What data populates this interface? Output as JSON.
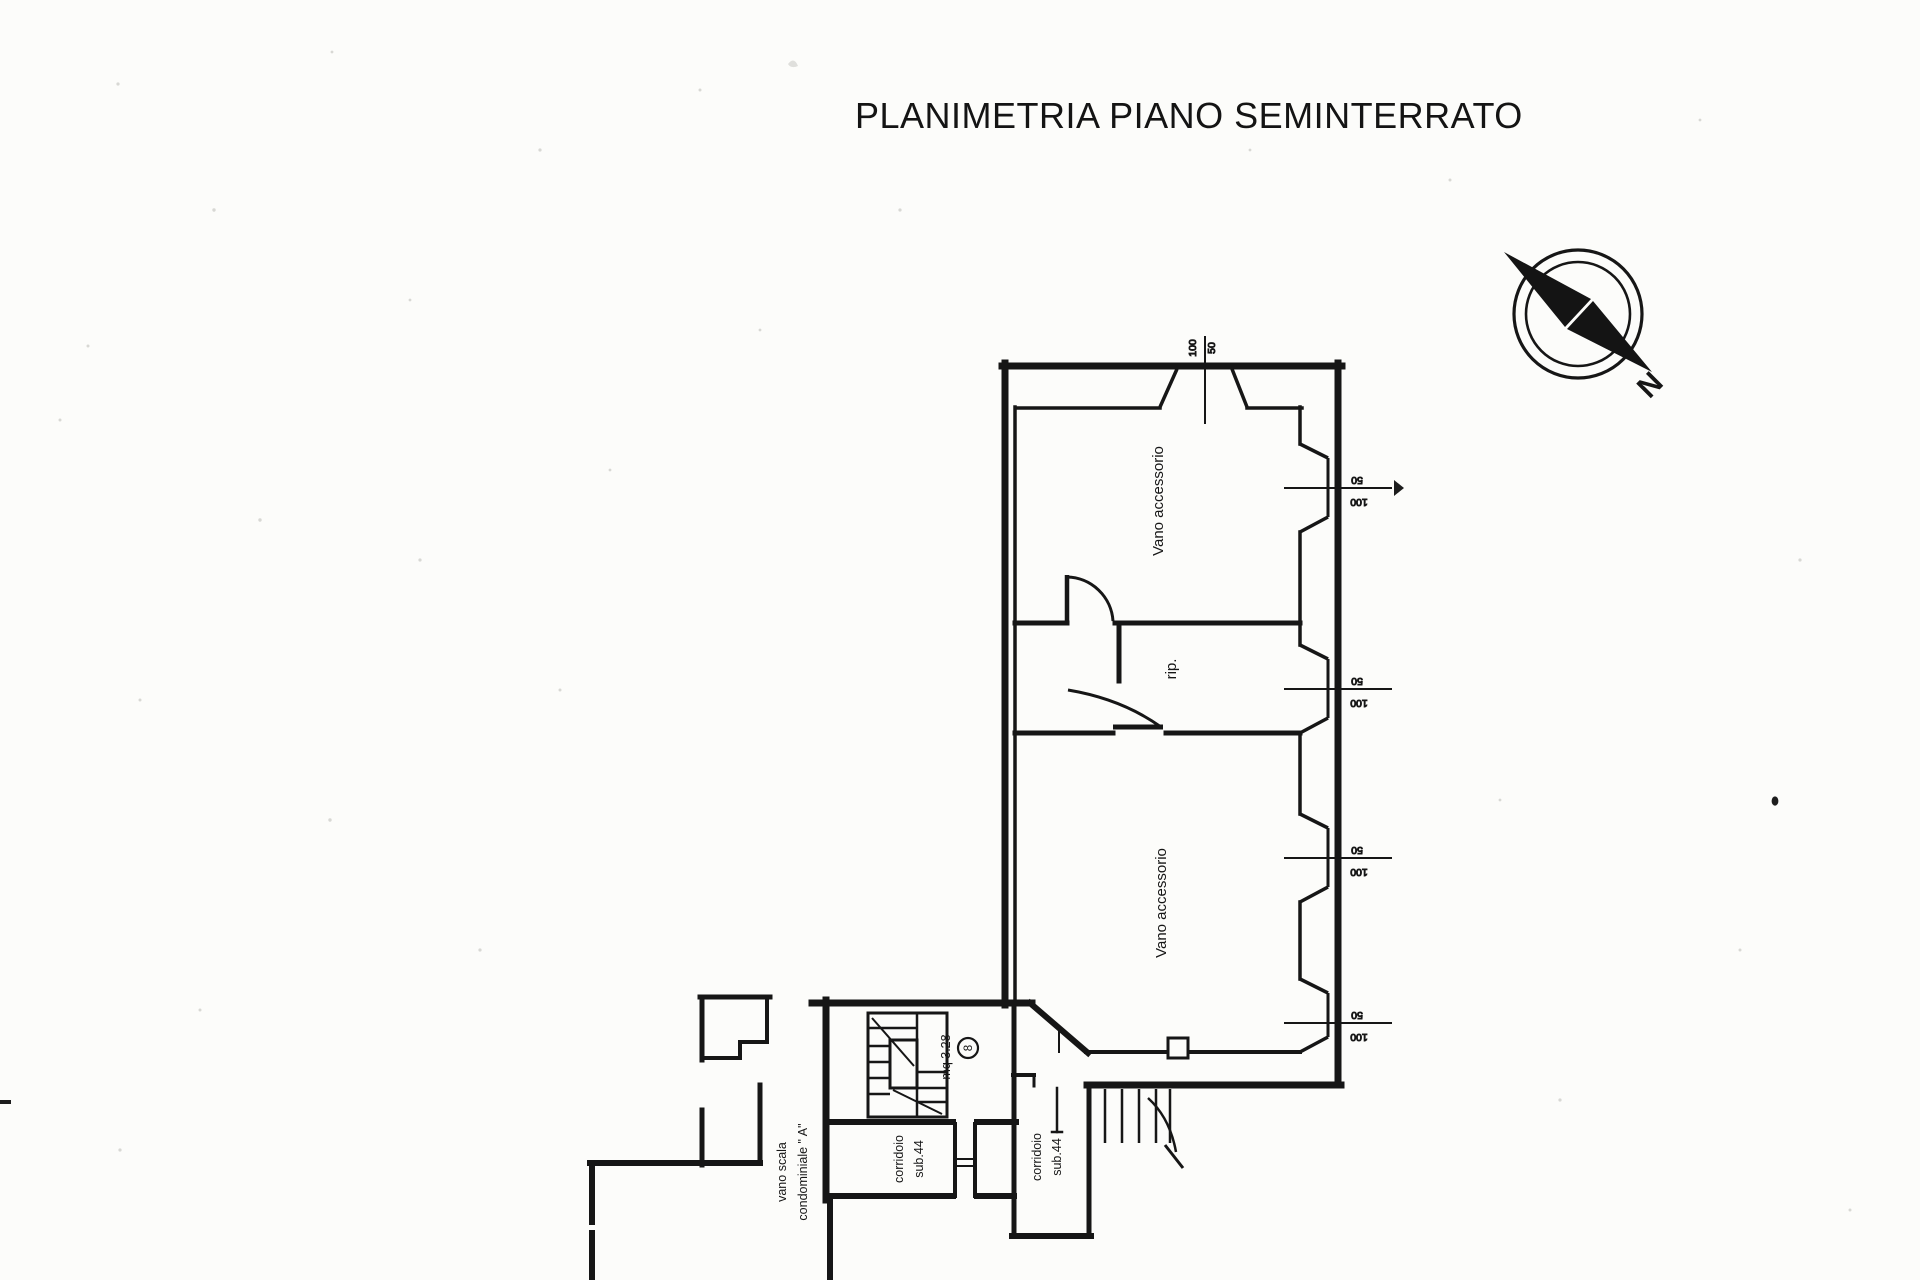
{
  "title": "PLANIMETRIA PIANO SEMINTERRATO",
  "colors": {
    "paper": "#fcfcfa",
    "ink": "#161616"
  },
  "compass": {
    "label": "N"
  },
  "rooms": {
    "vano_top": "Vano accessorio",
    "rip": "rip.",
    "vano_bottom": "Vano accessorio",
    "mq": "mq 3.28",
    "mq_number": "8",
    "corridoio_line1": "corridoio",
    "corridoio_line2": "sub.44",
    "scala_line1": "vano scala",
    "scala_line2": "condominiale \" A\""
  },
  "dimensions": {
    "top_window": {
      "w": "100",
      "h": "50"
    },
    "right_windows": [
      {
        "h": "50",
        "w": "100"
      },
      {
        "h": "50",
        "w": "100"
      },
      {
        "h": "50",
        "w": "100"
      },
      {
        "h": "50",
        "w": "100"
      }
    ]
  }
}
